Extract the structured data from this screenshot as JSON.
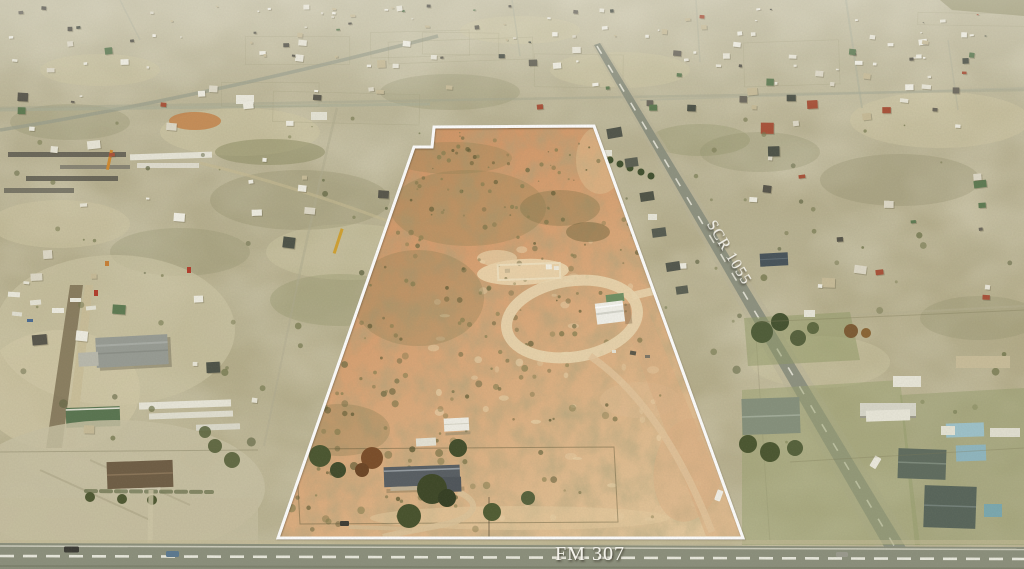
{
  "labels": {
    "fm_307": "FM 307",
    "scr_1055": "SCR 1055"
  },
  "overlay": {
    "boundary_color": "#ffffff",
    "label_color": "#f4f2ea"
  },
  "palette": {
    "terrain_base": "#b4ac8b",
    "terrain_light": "#cfc7a4",
    "terrain_olive": "#9a9871",
    "property_orange": "#d49a6c",
    "property_tan": "#e2c79c",
    "property_sand": "#ecd7ae",
    "scrub_dark": "#6e6a42",
    "road_paved": "#8d9180",
    "road_dirt": "#d9c49c",
    "lawn_green": "#97a06d",
    "roof_dark": "#555a50",
    "roof_metal_blue": "#9dc2cb",
    "building_white": "#efede2",
    "tree_green": "#49552f",
    "tree_rust": "#7d5a33"
  }
}
